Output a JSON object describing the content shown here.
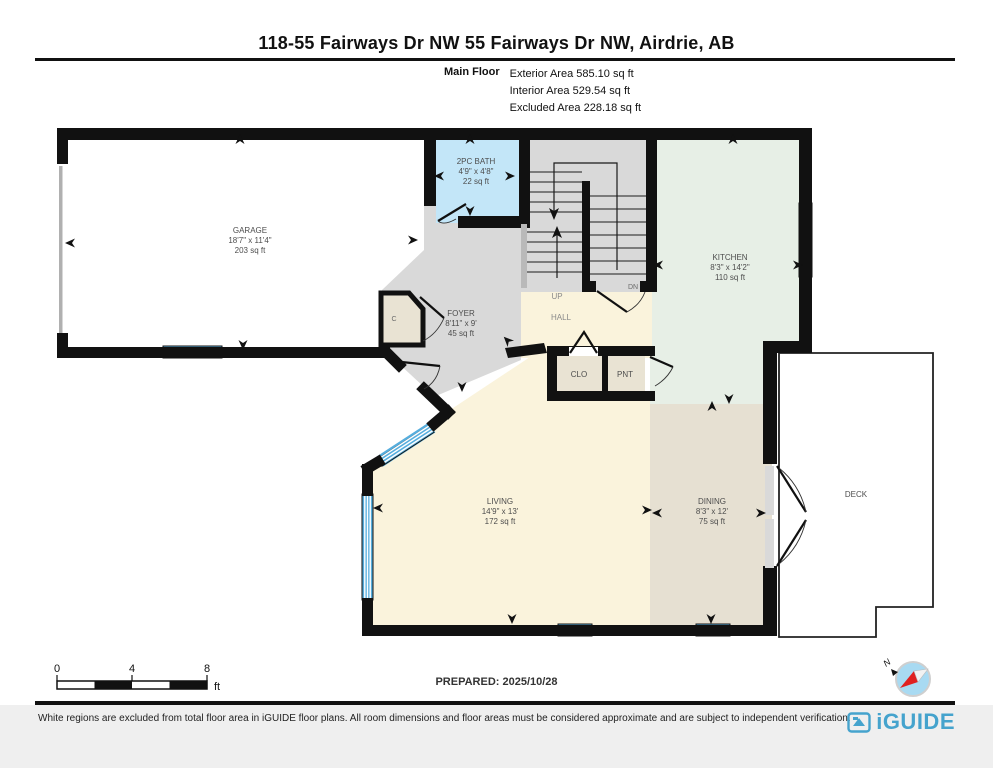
{
  "header": {
    "title": "118-55 Fairways Dr NW 55 Fairways Dr NW, Airdrie, AB",
    "floor_label": "Main Floor",
    "area_lines": [
      "Exterior Area 585.10 sq ft",
      "Interior Area 529.54 sq ft",
      "Excluded Area 228.18 sq ft"
    ]
  },
  "rooms": {
    "garage": {
      "name": "GARAGE",
      "dims": "18'7\" x 11'4\"",
      "area": "203 sq ft"
    },
    "bath": {
      "name": "2PC BATH",
      "dims": "4'9\" x 4'8\"",
      "area": "22 sq ft"
    },
    "kitchen": {
      "name": "KITCHEN",
      "dims": "8'3\" x 14'2\"",
      "area": "110 sq ft"
    },
    "foyer": {
      "name": "FOYER",
      "dims": "8'11\" x 9'",
      "area": "45 sq ft"
    },
    "living": {
      "name": "LIVING",
      "dims": "14'9\" x 13'",
      "area": "172 sq ft"
    },
    "dining": {
      "name": "DINING",
      "dims": "8'3\" x 12'",
      "area": "75 sq ft"
    },
    "deck": {
      "name": "DECK"
    },
    "hall": {
      "name": "HALL"
    },
    "closet": {
      "name": "CLO"
    },
    "pantry": {
      "name": "PNT"
    },
    "closet_c": {
      "name": "C"
    }
  },
  "stairs": {
    "up_label": "UP",
    "down_label": "DN"
  },
  "scale_bar": {
    "ticks": [
      "0",
      "4",
      "8"
    ],
    "unit": "ft"
  },
  "prepared_label": "PREPARED: 2025/10/28",
  "compass": {
    "north_label": "N"
  },
  "footer": {
    "disclaimer": "White regions are excluded from total floor area in iGUIDE floor plans. All room dimensions and floor areas must be considered approximate and are subject to independent verification.",
    "brand": "iGUIDE"
  },
  "colors": {
    "wall": "#111111",
    "window": "#56aede",
    "bath": "#c3e6f8",
    "kitchen": "#e7efe6",
    "dining": "#e6e0d2",
    "living": "#faf3dc",
    "foyer": "#d9d9d9",
    "closet": "#e9e3d3",
    "brand_blue": "#45a3cd"
  }
}
